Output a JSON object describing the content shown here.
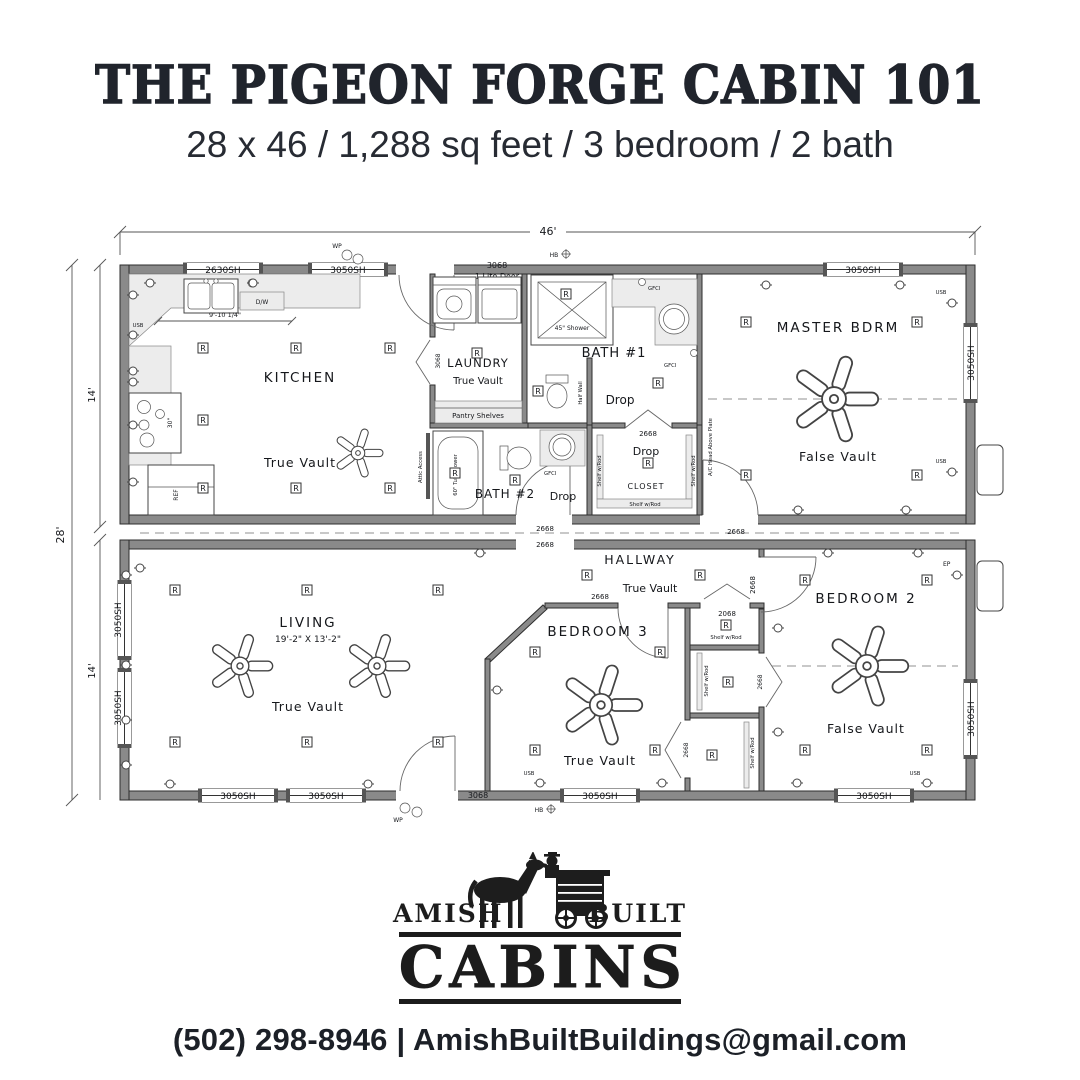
{
  "header": {
    "title": "THE PIGEON FORGE CABIN 101",
    "subtitle": "28 x 46 / 1,288 sq feet / 3 bedroom / 2 bath"
  },
  "plan": {
    "dims": {
      "width": "46'",
      "height": "28'",
      "half_upper": "14'",
      "half_lower": "14'"
    },
    "rooms": {
      "kitchen": "KITCHEN",
      "laundry": "LAUNDRY",
      "bath1": "BATH #1",
      "bath2": "BATH #2",
      "closet": "CLOSET",
      "master": "MASTER BDRM",
      "hallway": "HALLWAY",
      "living": "LIVING",
      "living_size": "19'-2\" X 13'-2\"",
      "bedroom3": "BEDROOM 3",
      "bedroom2": "BEDROOM 2"
    },
    "labels": {
      "r": "R",
      "usb": "USB",
      "gfci": "GFCI",
      "wp": "WP",
      "hb": "HB",
      "ep": "EP",
      "w2630": "2630SH",
      "w3050": "3050SH",
      "d3068": "3068",
      "d3068_lite": "1 Lite Door",
      "d2668": "2668",
      "d2068": "2068",
      "drop": "Drop",
      "true_vault": "True Vault",
      "false_vault": "False Vault",
      "shelf": "Shelf w/Rod",
      "pantry": "Pantry Shelves",
      "shower": "45\" Shower",
      "tub": "60\" Tub/Shower",
      "half_wall": "Half Wall",
      "attic": "Attic Access",
      "ac_head": "A/C Head Above Plate",
      "dw": "D/W",
      "ref": "REF",
      "range": "30\"",
      "counter_dim": "9'-10 1/4\""
    }
  },
  "logo": {
    "amish": "AMISH",
    "built": "BUILT",
    "cabins": "CABINS"
  },
  "footer": {
    "phone": "(502) 298-8946",
    "divider": "|",
    "email": "AmishBuiltBuildings@gmail.com"
  }
}
